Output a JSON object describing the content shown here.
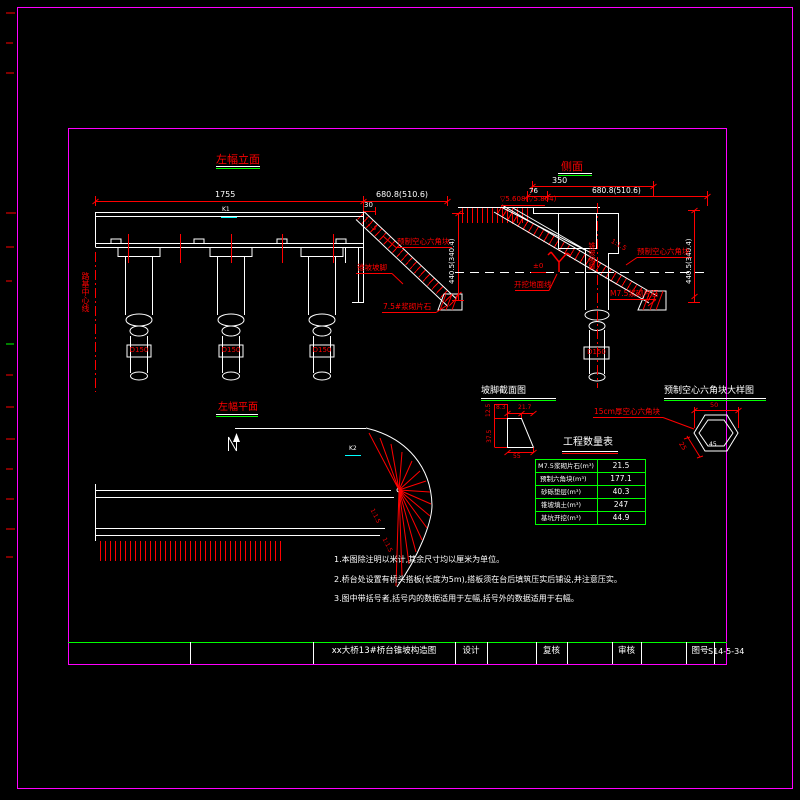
{
  "colors": {
    "line": "#ffffff",
    "accent": "#ff0000",
    "frame": "#ff00ff",
    "table_border": "#00ff00",
    "marker": "#00ffff"
  },
  "left_elevation": {
    "title": "左幅立面",
    "dim_span": "1755",
    "dim_right": "680.8(510.6)",
    "dim_offset": "30",
    "dim_height": "440.5(340.4)",
    "slope_ratio": "1:1.5",
    "label_precast_block": "预制空心六角块",
    "label_slope_toe": "锥坡坡脚",
    "label_rubble": "7.5#浆砌片石",
    "label_centerline": "路基中心线",
    "marker_k1": "K1",
    "pile_dia": "D150"
  },
  "side_view": {
    "title": "侧面",
    "dim_top": "350",
    "dim_offset": "76",
    "dim_right": "680.8(510.6)",
    "dim_height": "440.5(340.4)",
    "label_elevation": "▽5.608(▽5.804)",
    "label_zero": "±0",
    "label_excavation": "开挖地面线",
    "slope_ratio": "1:1.5",
    "label_precast_block": "预制空心六角块",
    "label_rubble": "M7.5浆砌片石",
    "label_slope_toe": "锥坡坡脚",
    "pile_dia": "D150"
  },
  "plan_view": {
    "title": "左幅平面",
    "marker_k2": "K2",
    "slope_ratio_1": "1:1.5",
    "slope_ratio_2": "1:1.5"
  },
  "toe_section": {
    "title": "坡脚截面图",
    "dim_top_left": "12.5",
    "dim_top_a": "8.3",
    "dim_top_b": "21.7",
    "dim_side": "37.5",
    "dim_bottom": "55"
  },
  "hex_detail": {
    "title": "预制空心六角块大样图",
    "label": "15cm厚空心六角块",
    "dim_width": "50",
    "dim_side": "25",
    "dim_flat": "45"
  },
  "quantity_table": {
    "title": "工程数量表",
    "rows": [
      {
        "item": "M7.5浆砌片石(m³)",
        "value": "21.5"
      },
      {
        "item": "预制六角块(m³)",
        "value": "177.1"
      },
      {
        "item": "砂砾垫层(m³)",
        "value": "40.3"
      },
      {
        "item": "锥坡填土(m³)",
        "value": "247"
      },
      {
        "item": "基坑开挖(m³)",
        "value": "44.9"
      }
    ]
  },
  "notes": [
    "1.本图除注明以米计,其余尺寸均以厘米为单位。",
    "2.桥台处设置有桥头搭板(长度为5m),搭板须在台后填筑压实后铺设,并注意压实。",
    "3.图中带括号者,括号内的数据适用于左幅,括号外的数据适用于右幅。"
  ],
  "title_block": {
    "drawing_title": "xx大桥13#桥台锥坡构造图",
    "design_label": "设计",
    "check_label": "复核",
    "review_label": "审核",
    "figure_no_label": "图号",
    "figure_no": "S14-5-34"
  }
}
